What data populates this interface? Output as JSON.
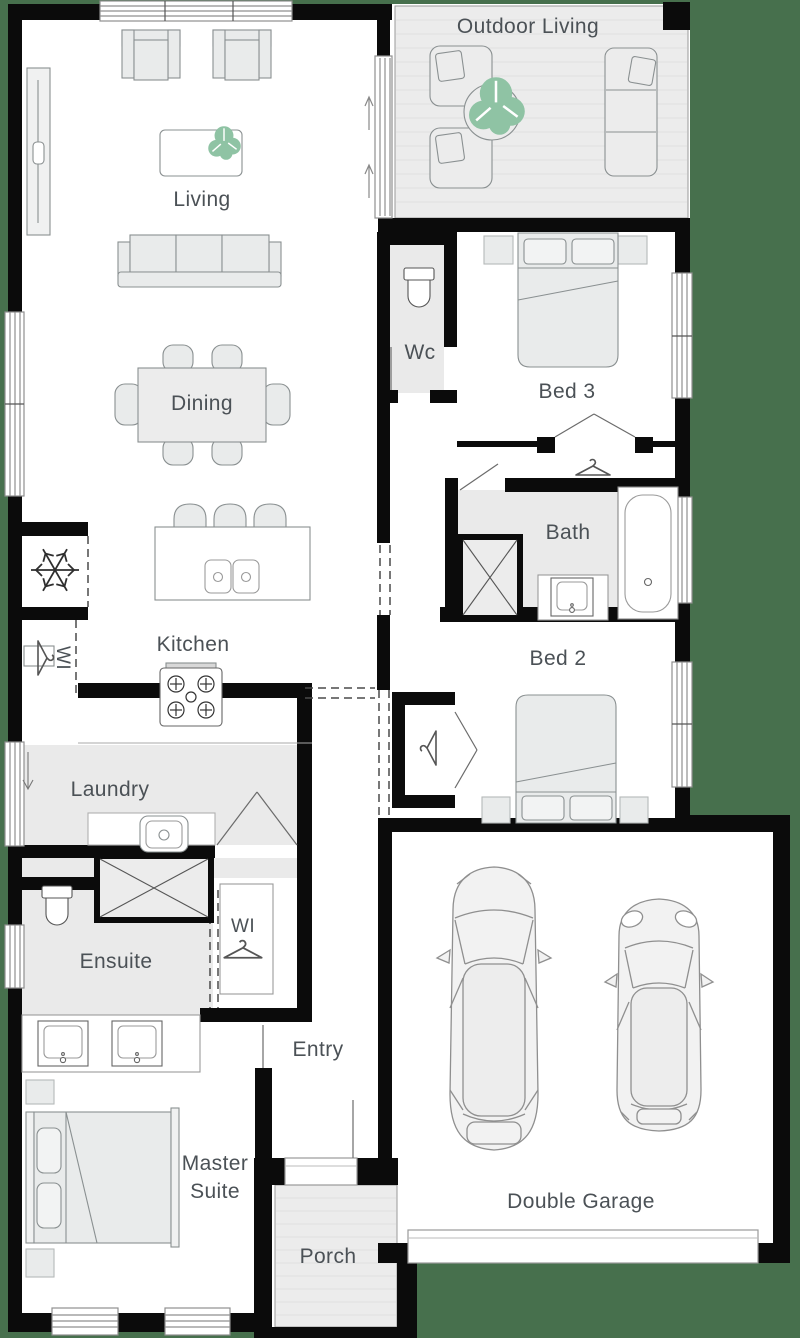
{
  "plan": {
    "title": "Single storey house floor plan",
    "rooms": {
      "outdoor_living": {
        "label": "Outdoor Living"
      },
      "living": {
        "label": "Living"
      },
      "dining": {
        "label": "Dining"
      },
      "kitchen": {
        "label": "Kitchen"
      },
      "wc": {
        "label": "Wc"
      },
      "bed3": {
        "label": "Bed 3"
      },
      "bath": {
        "label": "Bath"
      },
      "bed2": {
        "label": "Bed 2"
      },
      "laundry": {
        "label": "Laundry"
      },
      "ensuite": {
        "label": "Ensuite"
      },
      "walk_in_robe": {
        "label": "WI"
      },
      "walk_in_pantry": {
        "label": "WI"
      },
      "entry": {
        "label": "Entry"
      },
      "master_suite": {
        "label_line1": "Master",
        "label_line2": "Suite"
      },
      "porch": {
        "label": "Porch"
      },
      "double_garage": {
        "label": "Double Garage"
      }
    },
    "colors": {
      "background": "#47704D",
      "walls": "#0b0b0b",
      "floor": "#ffffff",
      "wet_floor": "#eaeaea",
      "decking": "#ececec",
      "furniture_stroke": "#8a9091",
      "plant": "#8fc3a4",
      "label_text": "#4b5156"
    },
    "icons": {
      "fridge": "snowflake-icon",
      "wardrobe": "hanger-icon",
      "door_swing": "arrow-icon",
      "garage": "car-icon",
      "plant": "plant-icon"
    }
  }
}
